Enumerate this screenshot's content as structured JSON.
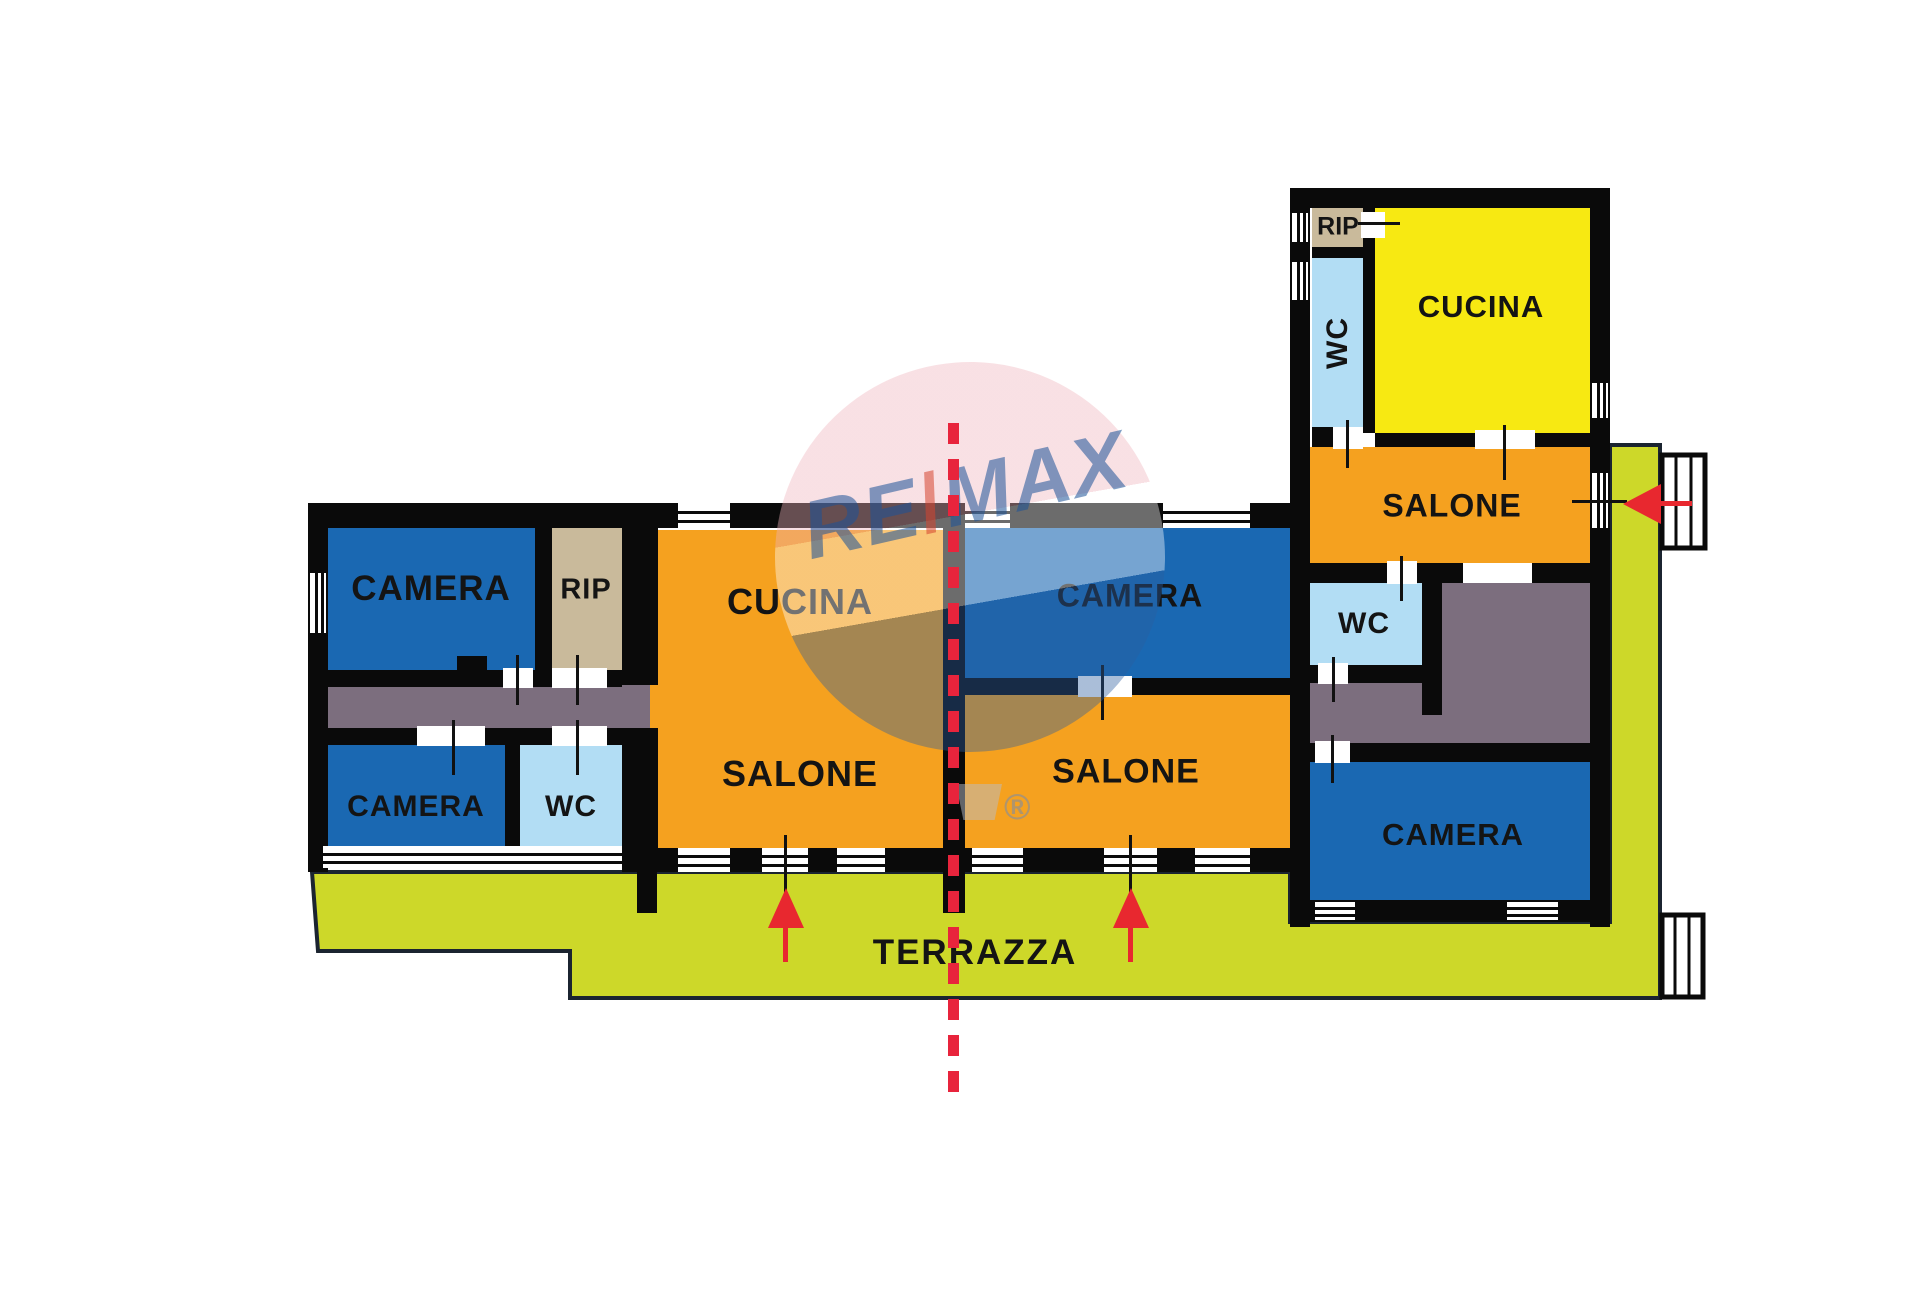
{
  "title": "Planimetria immobile RE/MAX",
  "colors": {
    "wall": "#0a0a0a",
    "blue": "#1a68b2",
    "lightblue": "#b2ddf4",
    "tan": "#c9ba9b",
    "gray": "#7c6e7e",
    "orange": "#f5a11f",
    "yellow": "#f7e912",
    "green": "#cdd829",
    "red": "#e8282f",
    "red-dash": "#e8243c",
    "ink": "#141414",
    "balloon-pink": "#efb3bc",
    "balloon-blue": "#2a5d9f",
    "brand-blue": "#1d5398"
  },
  "watermark": {
    "re": "RE",
    "slash": "/",
    "max": "MAX",
    "registered": "®"
  },
  "terrace": {
    "label": "TERRAZZA"
  },
  "unit_left": {
    "camera_top": "CAMERA",
    "rip": "RIP",
    "camera_bottom": "CAMERA",
    "wc": "WC",
    "cucina": "CUCINA",
    "salone": "SALONE"
  },
  "unit_center": {
    "camera": "CAMERA",
    "salone": "SALONE"
  },
  "unit_right": {
    "rip": "RIP",
    "wc_top": "WC",
    "cucina": "CUCINA",
    "salone": "SALONE",
    "wc_mid": "WC",
    "camera": "CAMERA"
  }
}
